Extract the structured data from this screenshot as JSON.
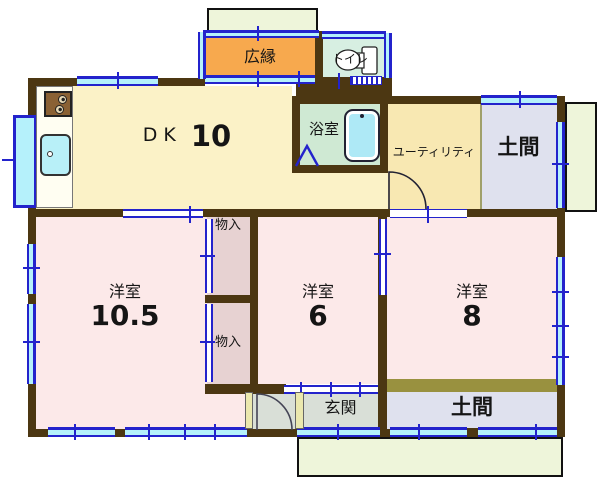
{
  "title": "floor-plan",
  "colors": {
    "wall": "#4c3712",
    "olive": "#99913f",
    "dk": "#fbf2c7",
    "utility_fill": "#f8e8b2",
    "hiroen_fill": "#f7a94e",
    "toilet_fill": "#d7efe2",
    "bath_fill": "#cfe9d3",
    "doma_fill": "#dfe1ee",
    "pink": "#fce9e9",
    "closet_fill": "#e7d2d2",
    "genkan_fill": "#d9dfd7",
    "porch": "#eef5da",
    "wincyan": "#b5f1fb",
    "blue": "#2323cc",
    "tub": "#aee9f6",
    "sink": "#b8f0f8",
    "stove": "#8a6134",
    "shoe": "#ebe8ae"
  },
  "rooms": {
    "dk": {
      "label": "DK",
      "size": "10"
    },
    "hiroen": {
      "label": "広縁"
    },
    "toilet": {
      "label": "トイレ"
    },
    "bath": {
      "label": "浴室"
    },
    "utility": {
      "label": "ユーティリティ"
    },
    "doma_upper": {
      "label": "土間"
    },
    "doma_lower": {
      "label": "土間"
    },
    "room_large": {
      "label": "洋室",
      "size": "10.5"
    },
    "room_mid": {
      "label": "洋室",
      "size": "6"
    },
    "room_right": {
      "label": "洋室",
      "size": "8"
    },
    "closet_upper": {
      "label": "物入"
    },
    "closet_lower": {
      "label": "物入"
    },
    "genkan": {
      "label": "玄関"
    }
  },
  "icons": {
    "toilet": "toilet-icon",
    "bathtub": "bathtub-icon",
    "stove": "stove-icon",
    "sink": "sink-icon"
  }
}
